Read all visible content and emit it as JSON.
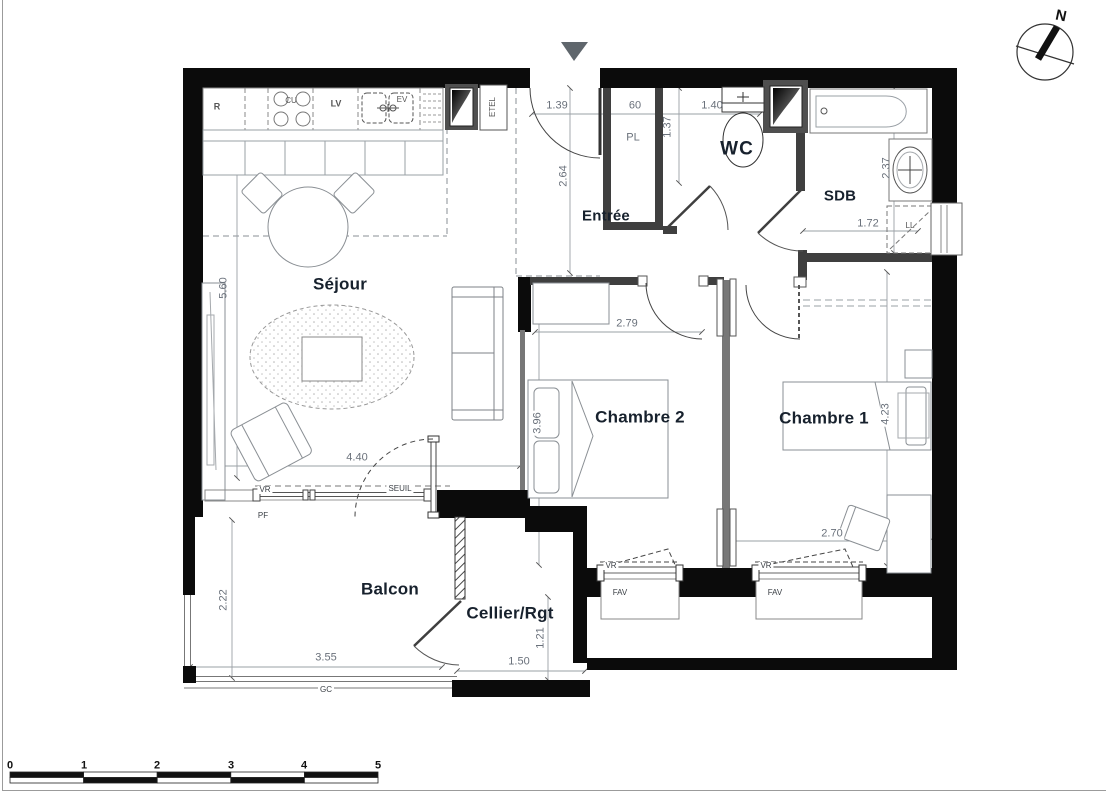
{
  "rooms": {
    "sejour": "Séjour",
    "entree": "Entrée",
    "wc": "WC",
    "sdb": "SDB",
    "chambre2": "Chambre 2",
    "chambre1": "Chambre 1",
    "balcon": "Balcon",
    "cellier": "Cellier/Rgt"
  },
  "fixtures": {
    "fridge": "R",
    "cooktop": "CU",
    "dishwasher": "LV",
    "sink": "EV",
    "column_unit": "ETEL",
    "closet": "PL",
    "washing_machine": "LL"
  },
  "openings": {
    "roller_shutter": "VR",
    "threshold": "SEUIL",
    "fixed_pane": "PF",
    "awning_window": "FAV",
    "guardrail": "GC"
  },
  "dimensions": {
    "entry_door_width": "1.39",
    "closet_width": "60",
    "wc_width": "1.40",
    "entry_depth": "2.64",
    "closet_depth": "1.37",
    "sdb_depth": "2.37",
    "sdb_width": "1.72",
    "sejour_depth": "5.60",
    "sejour_width": "4.40",
    "chambre2_width": "2.79",
    "chambre2_depth": "3.96",
    "chambre1_depth": "4.23",
    "chambre1_width": "2.70",
    "balcon_depth": "2.22",
    "balcon_width": "3.55",
    "cellier_width": "1.50",
    "cellier_depth": "1.21"
  },
  "compass": {
    "north": "N"
  },
  "scale_bar": {
    "ticks": [
      "0",
      "1",
      "2",
      "3",
      "4",
      "5"
    ]
  },
  "colors": {
    "wall": "#0b0b0b",
    "interior_wall": "#3f3f3f",
    "dim_text": "#6a717b",
    "room_text": "#17212d"
  }
}
